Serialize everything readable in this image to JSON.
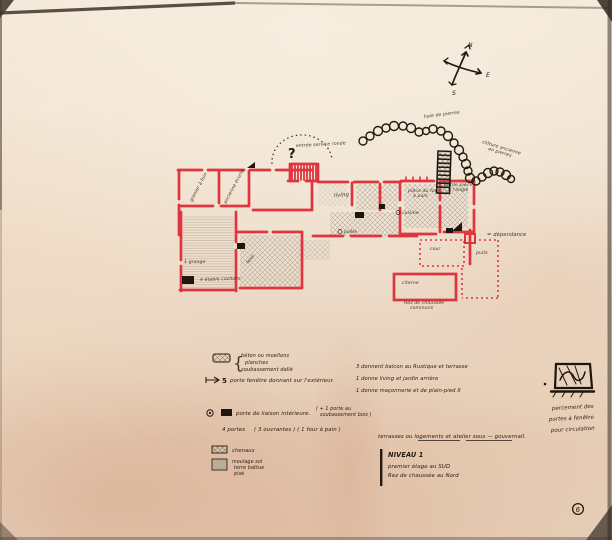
{
  "compass": {
    "n": "N",
    "e": "E",
    "s": "S"
  },
  "plan": {
    "labels": {
      "question": "?",
      "entree": "entrée service ronde",
      "haie": "haie de pierres",
      "cloture1": "clôture ancienne",
      "cloture2": "en pierres",
      "grenier": "grenier à foin",
      "ecurie": "ancienne écurie",
      "grange": "1 grange",
      "etable": "4 étable cochons",
      "fenil": "fenil",
      "living": "living",
      "poele": "poêle",
      "cuisine": "cuisine",
      "petite1": "petite pièce",
      "petite2": "à l'angle",
      "four1": "pièce du four",
      "four2": "à pain",
      "cour": "cour",
      "citerne": "citerne",
      "puits": "puits",
      "dependance": "= dépendance",
      "rdc1": "Rez de chaussée",
      "rdc2": "communs"
    }
  },
  "legend": {
    "materials_brace": "{",
    "materials": [
      "béton ou moellons",
      "planches",
      "soubassement dallé"
    ],
    "pf_count": "5",
    "pf_text": "porte fenêtre donnant sur l'extérieur.",
    "right_col": [
      "3  donnent balcon au Rustique et terrasse",
      "1  donne living et jardin arrière",
      "1  donne maçonnerie et de plain-pied X"
    ],
    "liaison_text": "porte de liaison intérieure.",
    "liaison_paren1": "( + 1 porte au",
    "liaison_paren2": "soubassement bois )",
    "portes4": "4  portes",
    "portes4_detail": "( 3 ouvrantes ) ( 1 four à pain )",
    "chenaux": "chenaux",
    "moulage": [
      "moulage sol",
      "terre battue",
      "pisé"
    ]
  },
  "notes": {
    "terrasse_note": "terrasses ou logements et atelier sous — gouvernail.",
    "niveau_title": "NIVEAU 1",
    "niveau_l1": "premier étage au SUD",
    "niveau_l2": "Rez de chaussée au Nord",
    "percement": [
      "percement des",
      "portes à fenêtre",
      "pour circulation"
    ],
    "page_mark": "6"
  },
  "colors": {
    "ink": "#241a10",
    "red_marker": "#dd2733",
    "paper": "#efe1cf"
  }
}
